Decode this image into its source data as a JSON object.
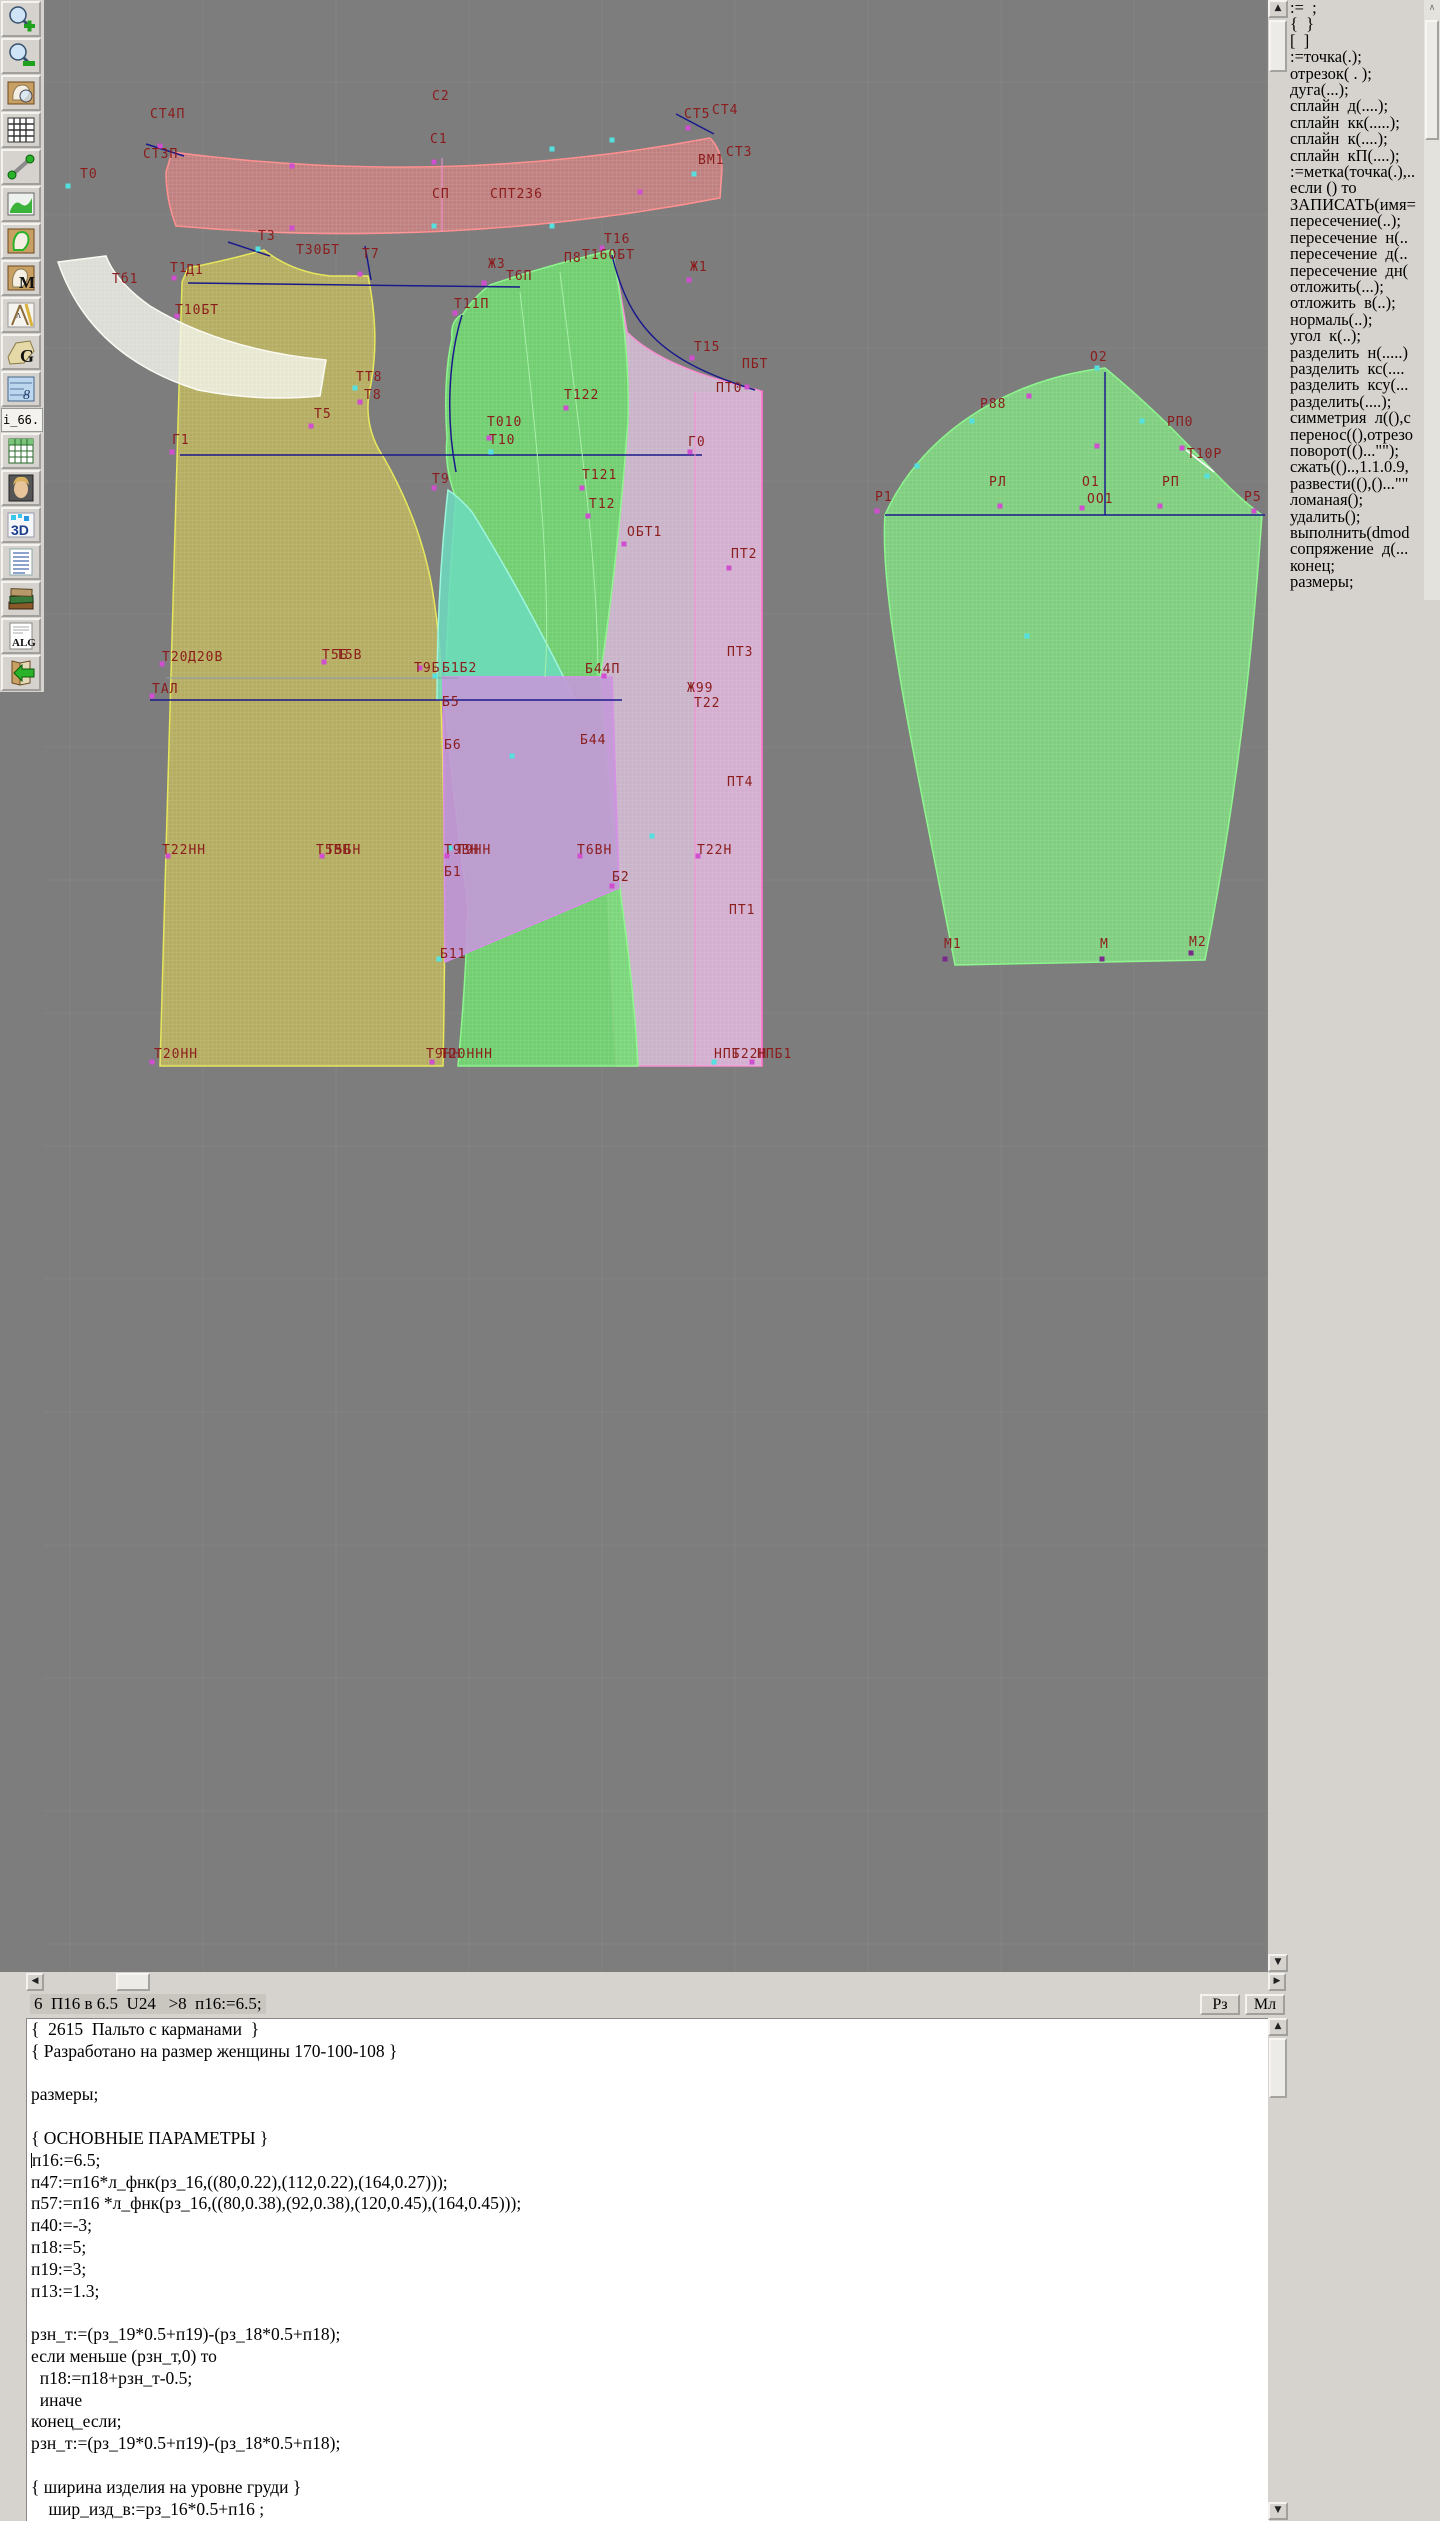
{
  "toolbar": {
    "i66_label": "i_66.",
    "items": [
      {
        "icon": "zoom-in"
      },
      {
        "icon": "zoom-out"
      },
      {
        "icon": "view-piece"
      },
      {
        "icon": "grid"
      },
      {
        "icon": "measure"
      },
      {
        "icon": "picture"
      },
      {
        "icon": "pattern-outline"
      },
      {
        "icon": "pattern-m"
      },
      {
        "icon": "drafting-tools"
      },
      {
        "icon": "pattern-g"
      },
      {
        "icon": "blueprint"
      },
      {
        "label": "i_66."
      },
      {
        "icon": "table"
      },
      {
        "icon": "portrait"
      },
      {
        "icon": "3d"
      },
      {
        "icon": "list"
      },
      {
        "icon": "books"
      },
      {
        "icon": "alg"
      },
      {
        "icon": "import"
      }
    ]
  },
  "sidebar": {
    "commands": [
      ":=  ;",
      "{  }",
      "[  ]",
      ":=точка(.);",
      "отрезок( . );",
      "дуга(...);",
      "сплайн  д(....);",
      "сплайн  кк(.....);",
      "сплайн  к(....);",
      "сплайн  кП(....);",
      ":=метка(точка(.),..",
      "если () то",
      "ЗАПИСАТЬ(имя=",
      "пересечение(..);",
      "пересечение  н(..",
      "пересечение  д(..",
      "пересечение  дн(",
      "отложить(...);",
      "отложить  в(..);",
      "нормаль(..);",
      "угол  к(..);",
      "разделить  н(.....)",
      "разделить  кс(....",
      "разделить  ксу(...",
      "разделить(....);",
      "симметрия  л((),с",
      "перенос((),отрезо",
      "поворот(()...\"\");",
      "сжать(()..,1.1.0.9,",
      "развести((),()...\"\"",
      "ломаная();",
      "удалить();",
      "выполнить(dmod",
      "сопряжение  д(...",
      "конец;",
      "размеры;"
    ]
  },
  "statusbar": {
    "left": "6  П16 в 6.5  U24   >8  п16:=6.5;",
    "rz": "Рз",
    "ml": "Мл"
  },
  "code": {
    "lines": [
      {
        "t": "{  2615  Пальто с карманами  }"
      },
      {
        "t": "{ Разработано на размер женщины 170-100-108 }"
      },
      {
        "t": ""
      },
      {
        "t": "размеры;"
      },
      {
        "t": ""
      },
      {
        "t": "{ ОСНОВНЫЕ ПАРАМЕТРЫ }"
      },
      {
        "t": "п16:=6.5;",
        "caret": true
      },
      {
        "t": "п47:=п16*л_фнк(рз_16,((80,0.22),(112,0.22),(164,0.27)));"
      },
      {
        "t": "п57:=п16 *л_фнк(рз_16,((80,0.38),(92,0.38),(120,0.45),(164,0.45)));"
      },
      {
        "t": "п40:=-3;"
      },
      {
        "t": "п18:=5;"
      },
      {
        "t": "п19:=3;"
      },
      {
        "t": "п13:=1.3;"
      },
      {
        "t": ""
      },
      {
        "t": "рзн_т:=(рз_19*0.5+п19)-(рз_18*0.5+п18);"
      },
      {
        "t": "если меньше (рзн_т,0) то"
      },
      {
        "t": "  п18:=п18+рзн_т-0.5;"
      },
      {
        "t": "  иначе"
      },
      {
        "t": "конец_если;"
      },
      {
        "t": "рзн_т:=(рз_19*0.5+п19)-(рз_18*0.5+п18);"
      },
      {
        "t": ""
      },
      {
        "t": "{ ширина изделия на уровне груди }"
      },
      {
        "t": "    шир_изд_в:=рз_16*0.5+п16 ;"
      }
    ]
  },
  "canvas": {
    "bg": "#7d7d7d",
    "grid_color": "#8a8a8a",
    "label_color": "#8b1c1c",
    "point_colors": {
      "m": "#cf4fcf",
      "c": "#55e0e0",
      "p": "#7a2a8a"
    },
    "pieces": [
      {
        "d": "M182,282 L188,268 Q228,260 264,250 Q292,272 330,276 L368,276 Q380,334 371,384 Q361,424 384,458 Q424,528 434,600 Q442,652 441,700 Q447,880 443,1066 L160,1066 Z",
        "f": "rgba(184,176,96,0.95)",
        "s": "#e6e65a",
        "h": true
      },
      {
        "d": "M58,262 Q90,356 198,390 Q260,402 320,396 L326,360 Q222,350 150,306 Q116,282 106,256 Z",
        "f": "rgba(245,245,238,0.8)",
        "s": "#fafaf2",
        "h": true
      },
      {
        "d": "M612,250 Q622,300 627,332 Q662,368 758,390 L762,392 L762,1066 L616,1066 Q606,900 600,677 Q618,560 628,420 Q630,340 612,250 Z",
        "f": "rgba(207,185,207,0.92)",
        "s": "#f78fd2",
        "h": true
      },
      {
        "d": "M695,392 L762,392 L762,1066 L695,1066 Z",
        "f": "rgba(238,170,225,0.3)",
        "s": "none",
        "h": false
      },
      {
        "d": "M490,285 Q545,266 612,250 Q630,340 628,420 Q618,560 600,677 Q608,790 622,905 Q634,990 638,1066 L458,1066 Q466,980 468,905 Q452,790 445,700 Q448,590 456,498 Q444,468 447,438 Q443,378 452,338 Q450,320 463,314 Q475,296 490,285 Z",
        "f": "rgba(112,219,112,0.88)",
        "s": "#8cf58c",
        "h": true
      },
      {
        "d": "M448,490 Q437,588 437,700 L575,700 Q522,592 472,512 Q459,497 448,490 Z",
        "f": "rgba(108,220,190,0.85)",
        "s": "#9df5dc",
        "h": false
      },
      {
        "d": "M443,677 L612,677 L619,888 L445,962 Z",
        "f": "rgba(196,152,216,0.9)",
        "s": "#d78fe8",
        "h": false
      },
      {
        "d": "M172,152 Q445,188 710,138 Q722,150 722,170 L720,198 Q448,250 176,226 Q166,200 166,172 Z",
        "f": "rgba(236,130,130,0.6)",
        "s": "#ff8f8f",
        "h": true
      },
      {
        "d": "M885,515 C918,440 1000,380 1105,368 C1190,438 1216,482 1262,515 C1256,600 1244,762 1205,960 L955,965 C916,762 879,600 885,515 Z",
        "f": "rgba(128,214,128,0.92)",
        "s": "#8cf58c",
        "h": true
      }
    ],
    "lines": [
      [
        188,
        283,
        520,
        287,
        "#1a1a8c",
        1.5
      ],
      [
        180,
        455,
        702,
        455,
        "#1a1a8c",
        1.5
      ],
      [
        150,
        700,
        622,
        700,
        "#1a1a8c",
        1.5
      ],
      [
        166,
        678,
        458,
        678,
        "#8f9bb0",
        1
      ],
      [
        885,
        515,
        1265,
        515,
        "#1a1a8c",
        1.5
      ],
      [
        1105,
        372,
        1105,
        515,
        "#1a1a8c",
        1.5
      ],
      [
        442,
        158,
        442,
        232,
        "#f78fd2",
        1
      ],
      [
        695,
        392,
        695,
        1066,
        "#f78fd2",
        1
      ],
      [
        762,
        390,
        762,
        1066,
        "#ff6fc8",
        1.5
      ],
      [
        228,
        242,
        270,
        256,
        "#1a1a8c",
        1.5
      ],
      [
        146,
        144,
        184,
        156,
        "#1a1a8c",
        1.5
      ],
      [
        676,
        114,
        714,
        134,
        "#1a1a8c",
        1.5
      ],
      [
        365,
        246,
        371,
        280,
        "#1a1a8c",
        1.5
      ],
      [
        1186,
        450,
        1214,
        472,
        "#ffffff",
        1.5
      ]
    ],
    "curves": [
      [
        "M612,255 C630,330 665,362 755,390",
        "#1a1a8c",
        1.5
      ],
      [
        "M520,292 C535,420 552,580 545,677",
        "#a8f0a8",
        1
      ],
      [
        "M560,272 C578,420 598,560 598,676",
        "#a8f0a8",
        1
      ],
      [
        "M462,315 C448,360 446,420 456,472",
        "#1a1a8c",
        1.5
      ]
    ],
    "labels": [
      [
        "СТ4П",
        150,
        118
      ],
      [
        "С2",
        432,
        100
      ],
      [
        "СТ5",
        684,
        118
      ],
      [
        "СТ4",
        712,
        114
      ],
      [
        "СТ3П",
        143,
        158
      ],
      [
        "С1",
        430,
        143
      ],
      [
        "ВМ1",
        698,
        164
      ],
      [
        "СТ3",
        726,
        156
      ],
      [
        "СП",
        432,
        198
      ],
      [
        "СПТ236",
        490,
        198
      ],
      [
        "Т0",
        80,
        178
      ],
      [
        "Тб1",
        112,
        283
      ],
      [
        "Т3",
        258,
        240
      ],
      [
        "Т30БТ",
        296,
        254
      ],
      [
        "Т7",
        362,
        258
      ],
      [
        "Т1",
        170,
        272
      ],
      [
        "Д1",
        186,
        274
      ],
      [
        "Т10БТ",
        175,
        314
      ],
      [
        "ТТ8",
        356,
        381
      ],
      [
        "Т8",
        364,
        399
      ],
      [
        "Т5",
        314,
        418
      ],
      [
        "Г1",
        172,
        444
      ],
      [
        "Ж3",
        488,
        268
      ],
      [
        "Т6П",
        506,
        280
      ],
      [
        "Т11П",
        454,
        308
      ],
      [
        "П8",
        564,
        262
      ],
      [
        "Т16ОБТ",
        582,
        259
      ],
      [
        "Т16",
        604,
        243
      ],
      [
        "Ж1",
        690,
        271
      ],
      [
        "Т15",
        694,
        351
      ],
      [
        "ПБТ",
        742,
        368
      ],
      [
        "ПТ0",
        716,
        392
      ],
      [
        "Т122",
        564,
        399
      ],
      [
        "Т010",
        487,
        426
      ],
      [
        "Т10",
        489,
        444
      ],
      [
        "Г0",
        688,
        446
      ],
      [
        "Т9",
        432,
        483
      ],
      [
        "Т121",
        582,
        479
      ],
      [
        "Т12",
        589,
        508
      ],
      [
        "ОБТ1",
        627,
        536
      ],
      [
        "ПТ2",
        731,
        558
      ],
      [
        "ПТ3",
        727,
        656
      ],
      [
        "Б44П",
        585,
        673
      ],
      [
        "Ж99",
        687,
        692
      ],
      [
        "Т22",
        694,
        707
      ],
      [
        "Б5",
        442,
        706
      ],
      [
        "Б44",
        580,
        744
      ],
      [
        "Б6",
        444,
        749
      ],
      [
        "ПТ4",
        727,
        786
      ],
      [
        "Т20",
        162,
        661
      ],
      [
        "Д20В",
        188,
        661
      ],
      [
        "Т5Б",
        322,
        659
      ],
      [
        "Т5В",
        336,
        659
      ],
      [
        "Т9Б",
        414,
        672
      ],
      [
        "Б1Б2",
        442,
        672
      ],
      [
        "ТАЛ",
        152,
        693
      ],
      [
        "Т22НН",
        162,
        854
      ],
      [
        "Т5ВН",
        316,
        854
      ],
      [
        "Т5БН",
        326,
        854
      ],
      [
        "Т9ВН",
        444,
        854
      ],
      [
        "Т9НН",
        456,
        854
      ],
      [
        "Б1",
        444,
        876
      ],
      [
        "Т6ВН",
        577,
        854
      ],
      [
        "Б2",
        612,
        881
      ],
      [
        "Т22Н",
        697,
        854
      ],
      [
        "ПТ1",
        729,
        914
      ],
      [
        "Б11",
        440,
        958
      ],
      [
        "Т20НН",
        154,
        1058
      ],
      [
        "Т9НН",
        426,
        1058
      ],
      [
        "Т20ННН",
        440,
        1058
      ],
      [
        "НПБ",
        714,
        1058
      ],
      [
        "Т22Н",
        732,
        1058
      ],
      [
        "НПБ1",
        757,
        1058
      ],
      [
        "О2",
        1090,
        361
      ],
      [
        "Р88",
        980,
        408
      ],
      [
        "РП0",
        1167,
        426
      ],
      [
        "Т10Р",
        1187,
        458
      ],
      [
        "РЛ",
        989,
        486
      ],
      [
        "О1",
        1082,
        486
      ],
      [
        "ОО1",
        1087,
        503
      ],
      [
        "РП",
        1162,
        486
      ],
      [
        "Р1",
        875,
        501
      ],
      [
        "Р5",
        1244,
        501
      ],
      [
        "М1",
        944,
        948
      ],
      [
        "М",
        1100,
        948
      ],
      [
        "М2",
        1189,
        946
      ]
    ],
    "points": [
      [
        160,
        146,
        "m"
      ],
      [
        434,
        162,
        "m"
      ],
      [
        434,
        226,
        "c"
      ],
      [
        292,
        166,
        "m"
      ],
      [
        552,
        149,
        "c"
      ],
      [
        612,
        140,
        "c"
      ],
      [
        688,
        128,
        "m"
      ],
      [
        694,
        174,
        "c"
      ],
      [
        640,
        192,
        "m"
      ],
      [
        552,
        226,
        "c"
      ],
      [
        292,
        228,
        "m"
      ],
      [
        68,
        186,
        "c"
      ],
      [
        174,
        278,
        "m"
      ],
      [
        177,
        316,
        "m"
      ],
      [
        258,
        249,
        "c"
      ],
      [
        360,
        274,
        "m"
      ],
      [
        355,
        388,
        "c"
      ],
      [
        360,
        402,
        "m"
      ],
      [
        311,
        426,
        "m"
      ],
      [
        172,
        452,
        "m"
      ],
      [
        455,
        313,
        "m"
      ],
      [
        484,
        283,
        "m"
      ],
      [
        602,
        248,
        "m"
      ],
      [
        689,
        280,
        "m"
      ],
      [
        692,
        358,
        "m"
      ],
      [
        747,
        387,
        "m"
      ],
      [
        566,
        408,
        "m"
      ],
      [
        489,
        438,
        "m"
      ],
      [
        491,
        452,
        "c"
      ],
      [
        690,
        452,
        "m"
      ],
      [
        434,
        488,
        "m"
      ],
      [
        582,
        488,
        "m"
      ],
      [
        588,
        516,
        "m"
      ],
      [
        624,
        544,
        "m"
      ],
      [
        729,
        568,
        "m"
      ],
      [
        435,
        676,
        "c"
      ],
      [
        604,
        676,
        "m"
      ],
      [
        612,
        886,
        "m"
      ],
      [
        439,
        959,
        "c"
      ],
      [
        512,
        756,
        "c"
      ],
      [
        652,
        836,
        "c"
      ],
      [
        450,
        848,
        "c"
      ],
      [
        162,
        664,
        "m"
      ],
      [
        324,
        662,
        "m"
      ],
      [
        420,
        668,
        "m"
      ],
      [
        152,
        696,
        "m"
      ],
      [
        168,
        856,
        "m"
      ],
      [
        322,
        856,
        "m"
      ],
      [
        447,
        856,
        "m"
      ],
      [
        580,
        856,
        "m"
      ],
      [
        698,
        856,
        "m"
      ],
      [
        152,
        1062,
        "m"
      ],
      [
        432,
        1062,
        "m"
      ],
      [
        714,
        1062,
        "c"
      ],
      [
        752,
        1062,
        "m"
      ],
      [
        1097,
        368,
        "c"
      ],
      [
        1029,
        396,
        "m"
      ],
      [
        972,
        421,
        "c"
      ],
      [
        917,
        466,
        "c"
      ],
      [
        877,
        511,
        "m"
      ],
      [
        1000,
        506,
        "m"
      ],
      [
        1082,
        508,
        "m"
      ],
      [
        1160,
        506,
        "m"
      ],
      [
        1254,
        511,
        "m"
      ],
      [
        1142,
        421,
        "c"
      ],
      [
        1182,
        448,
        "m"
      ],
      [
        1207,
        476,
        "c"
      ],
      [
        1097,
        446,
        "m"
      ],
      [
        1027,
        636,
        "c"
      ],
      [
        945,
        959,
        "p"
      ],
      [
        1102,
        959,
        "p"
      ],
      [
        1191,
        953,
        "p"
      ]
    ]
  }
}
